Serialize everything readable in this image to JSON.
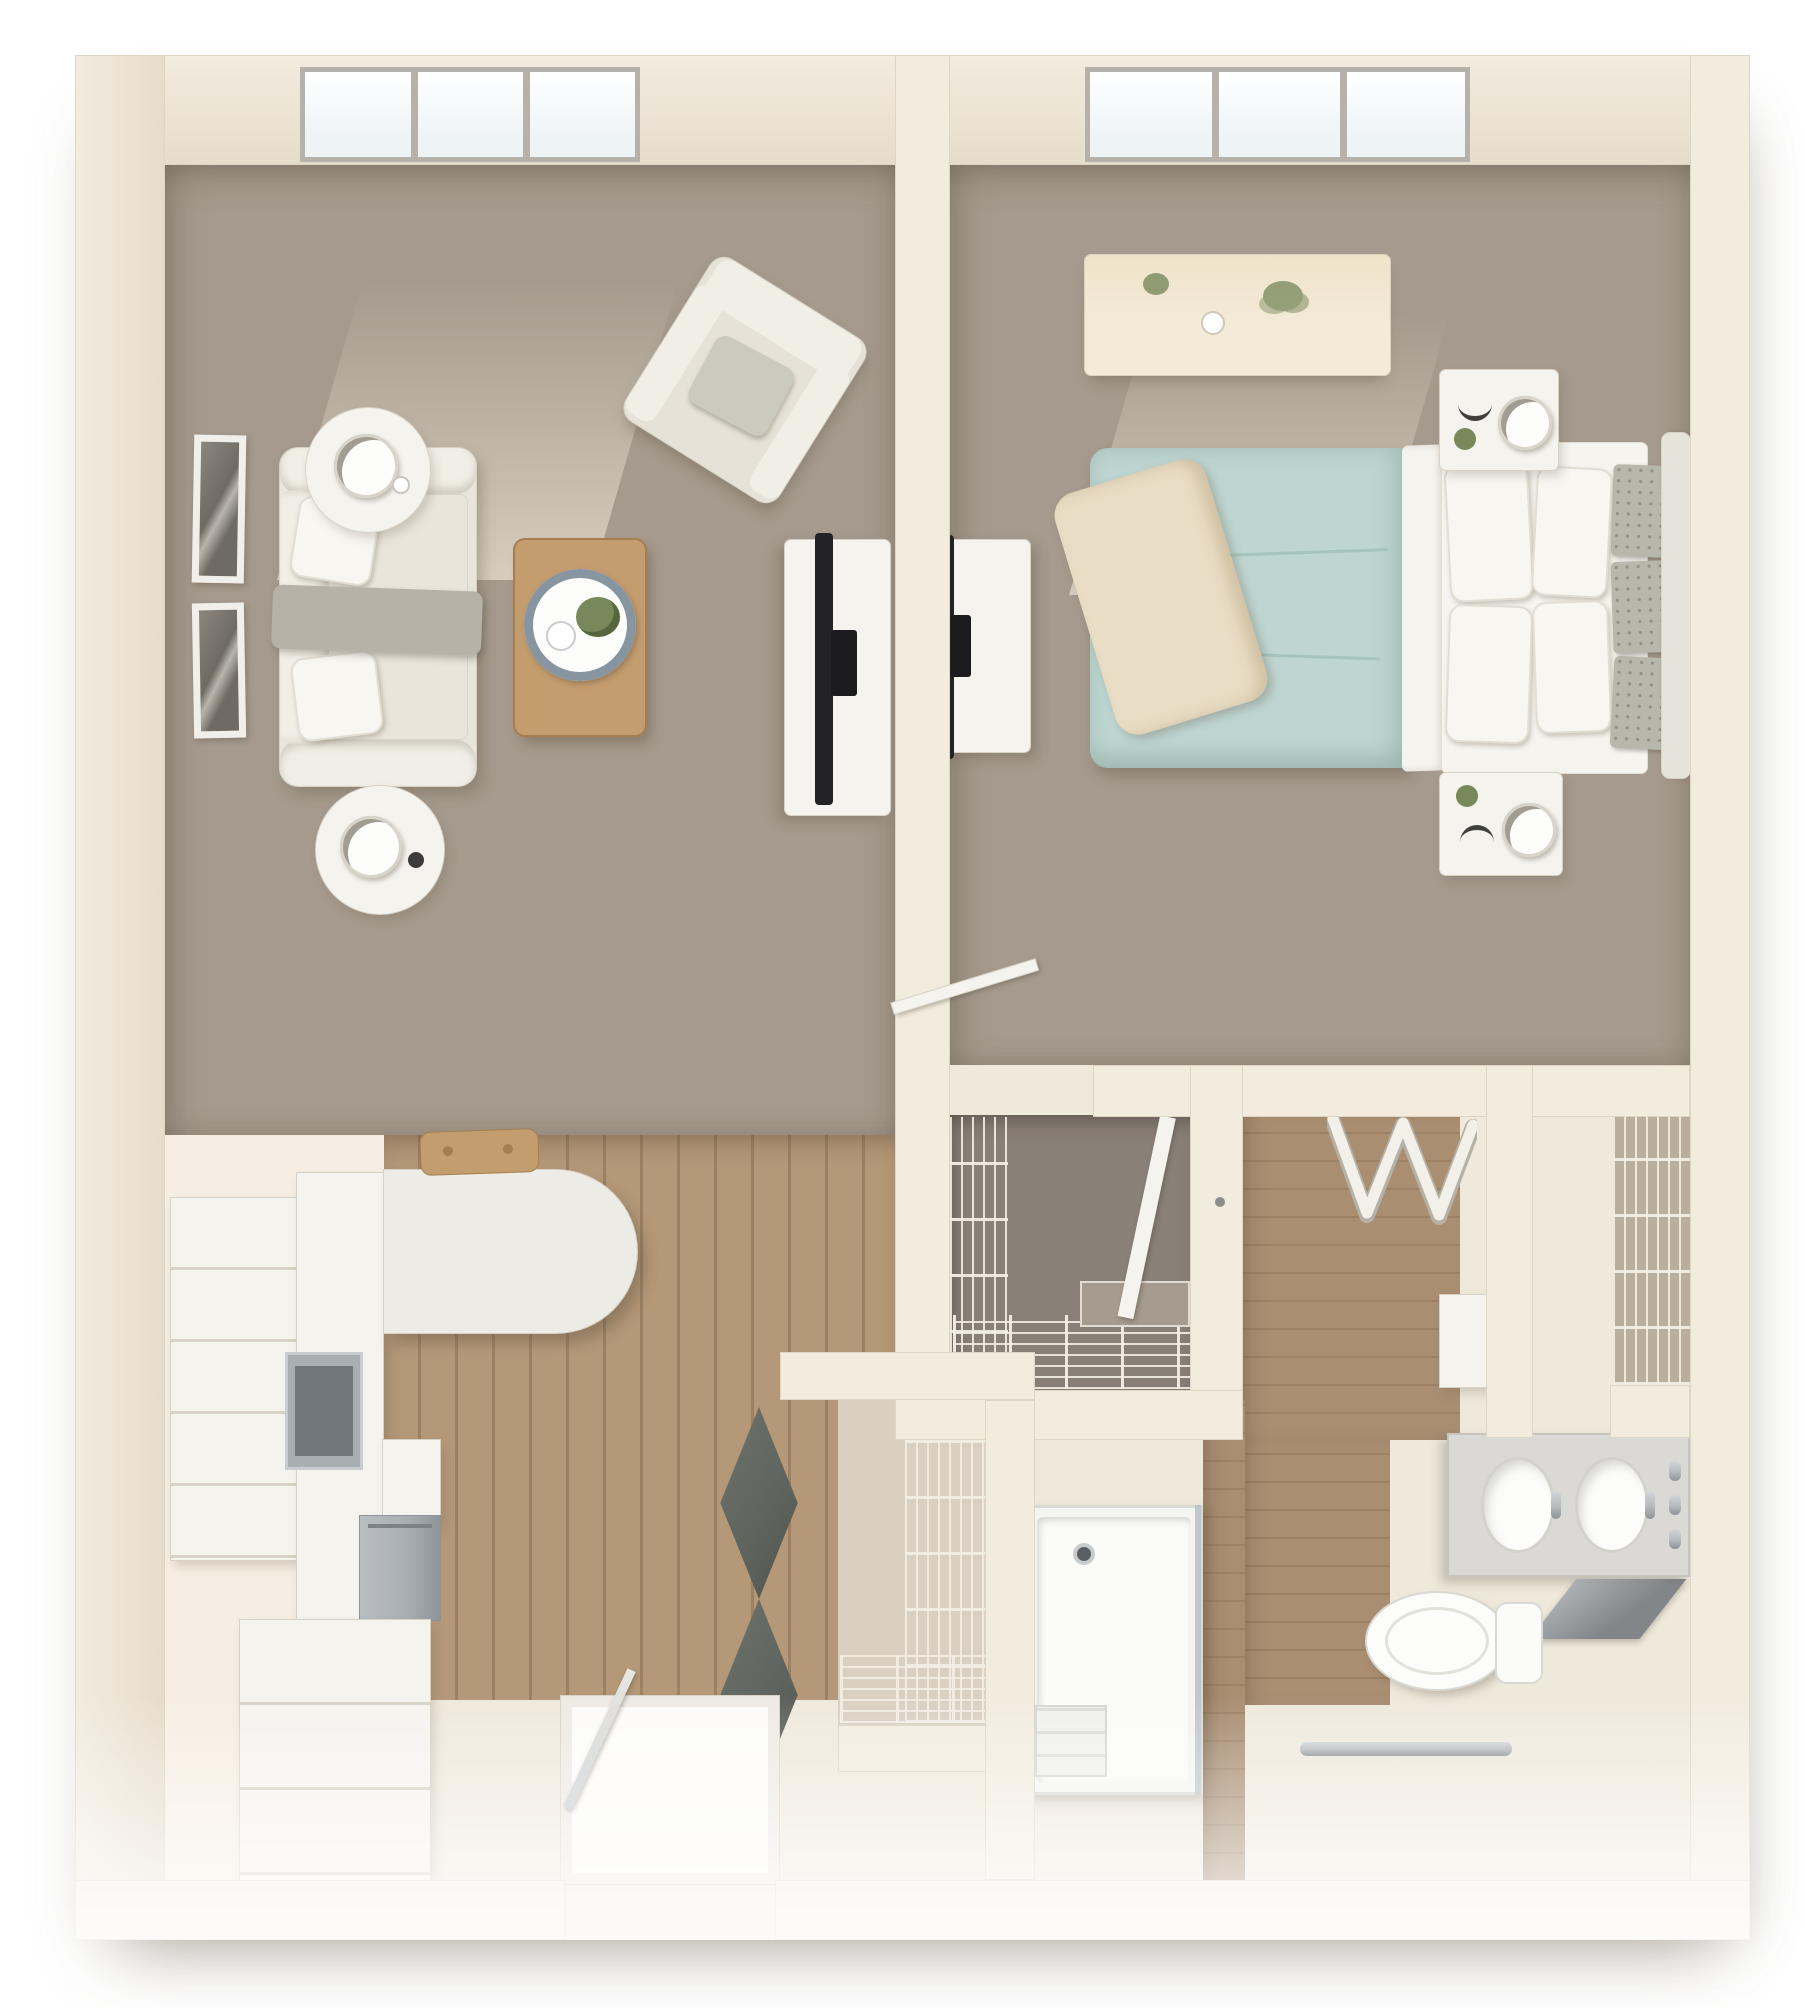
{
  "meta": {
    "title": "3D top-down floor plan render — one-bedroom apartment",
    "visible_text": [],
    "style": "photorealistic 3D dollhouse floor plan on white background"
  },
  "colors": {
    "bg": "#ffffff",
    "wall": "#f2ecdf",
    "wall-edge": "#ded5c2",
    "wall-shade": "#e6dccb",
    "carpet": "#a59a8d",
    "closet-carpet": "#898078",
    "wood": "#b49878",
    "wood-dark": "#9c8164",
    "bath-wood": "#a98e72",
    "pale-floor": "#f6eee2",
    "cream-floor": "#efe9dc",
    "white": "#f5f3ee",
    "furn-edge": "#d7d2c6",
    "sofa": "#e9e5da",
    "sofa-arm": "#f1eee6",
    "pillow": "#f8f6f1",
    "throw": "#b6b2a8",
    "chair": "#e7e2d7",
    "chair-pillow": "#ccc9be",
    "table-wood": "#c49d6e",
    "table-wood-dark": "#a57e4f",
    "tray-rim": "#8795a0",
    "plant": "#77885a",
    "tv": "#232327",
    "teal": "#bed5d1",
    "teal-dark": "#a6c4bd",
    "sheet": "#f6f4ef",
    "sham": "#b7b7ac",
    "cream-throw": "#e9ddc5",
    "steel": "#a9aeb2",
    "steel-dark": "#70767a",
    "chrome": "#b6babd",
    "dark-door": "#5f645e",
    "glass-blue": "#eef3f6",
    "window-frame": "#b6b2a9"
  },
  "rooms": {
    "living": {
      "label": "Living room",
      "furniture": [
        "window",
        "wall-art",
        "sofa",
        "throw-blanket",
        "accent-pillows",
        "round-side-tables",
        "table-lamp",
        "armchair",
        "coffee-table",
        "decor-tray",
        "tv-stand",
        "television"
      ]
    },
    "bedroom": {
      "label": "Bedroom",
      "furniture": [
        "window",
        "dresser",
        "plants",
        "bed",
        "duvet",
        "pillows",
        "accent-shams",
        "headboard",
        "nightstands",
        "lamps",
        "tv-stand",
        "television"
      ]
    },
    "kitchen": {
      "label": "Kitchen",
      "furniture": [
        "tall-cabinets",
        "wall-oven",
        "dishwasher",
        "base-cabinet",
        "peninsula-counter",
        "coat-rack"
      ]
    },
    "entry": {
      "label": "Entry",
      "furniture": [
        "entry-door",
        "door-mat"
      ]
    },
    "walkin": {
      "label": "Walk-in closet",
      "furniture": [
        "wire-shelving",
        "closet-door"
      ]
    },
    "utility": {
      "label": "Utility closet",
      "furniture": [
        "bifold-doors",
        "wire-shelving"
      ]
    },
    "linen": {
      "label": "Linen closet",
      "furniture": [
        "wire-shelving"
      ]
    },
    "bath": {
      "label": "Bathroom",
      "furniture": [
        "bifold-wardrobe",
        "double-sink-vanity",
        "faucets",
        "mirror",
        "toilet",
        "roll-in-shower",
        "shower-seat",
        "grab-bar"
      ]
    }
  }
}
